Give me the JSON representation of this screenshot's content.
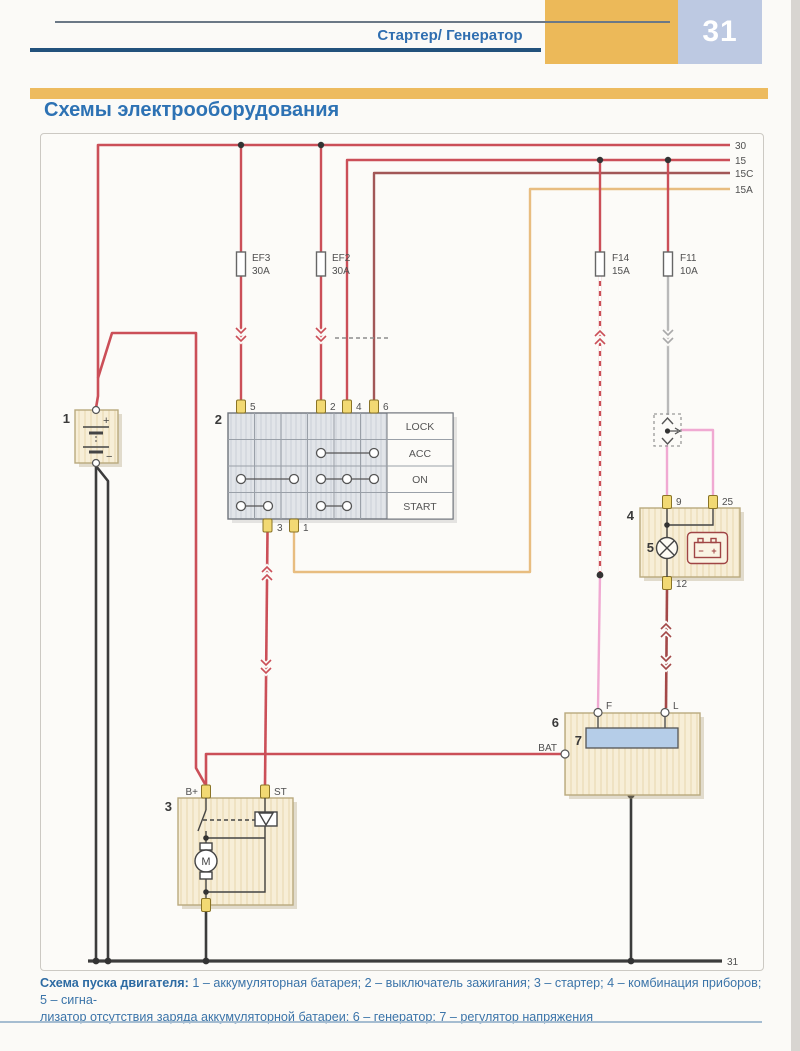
{
  "header": {
    "section_title": "Стартер/ Генератор",
    "page_number": "31"
  },
  "page_title": "Схемы электрооборудования",
  "diagram": {
    "bus_labels": {
      "b30": "30",
      "b15": "15",
      "b15c": "15C",
      "b15a": "15A",
      "b31": "31"
    },
    "fuses": {
      "ef3": {
        "name": "EF3",
        "rating": "30A"
      },
      "ef2": {
        "name": "EF2",
        "rating": "30A"
      },
      "f14": {
        "name": "F14",
        "rating": "15A"
      },
      "f11": {
        "name": "F11",
        "rating": "10A"
      }
    },
    "battery": {
      "num": "1",
      "plus": "+",
      "minus": "−"
    },
    "ignition": {
      "num": "2",
      "positions": {
        "lock": "LOCK",
        "acc": "ACC",
        "on": "ON",
        "start": "START"
      },
      "terminals": {
        "t5": "5",
        "t2": "2",
        "t4": "4",
        "t6": "6",
        "t3": "3",
        "t1": "1"
      }
    },
    "starter": {
      "num": "3",
      "bplus": "B+",
      "st": "ST",
      "motor": "M"
    },
    "cluster": {
      "num": "4",
      "lamp_num": "5",
      "t9": "9",
      "t25": "25",
      "t12": "12",
      "batt_minus": "−",
      "batt_plus": "+"
    },
    "generator": {
      "num": "6",
      "reg_num": "7",
      "f": "F",
      "l": "L",
      "bat": "BAT"
    }
  },
  "caption": {
    "lead": "Схема пуска двигателя:",
    "line1": " 1 – аккумуляторная батарея; 2 – выключатель зажигания; 3 – стартер; 4 – комбинация приборов; 5 – сигна-",
    "line2": "лизатор отсутствия заряда аккумуляторной батареи; 6 – генератор; 7 – регулятор напряжения"
  },
  "colors": {
    "wire_red": "#cb4f58",
    "wire_15c": "#a25757",
    "wire_orange": "#e8bd80",
    "wire_pink": "#f0a9d2",
    "wire_grey": "#b9b9b9",
    "wire_maroon": "#a34848",
    "wire_black": "#3c3c3c",
    "accent_blue": "#2d72b4",
    "band_orange": "#ecb959",
    "page_box_blue": "#bdc9e2",
    "component_fill": "#f7eed7",
    "regulator_fill": "#b5cde8"
  }
}
